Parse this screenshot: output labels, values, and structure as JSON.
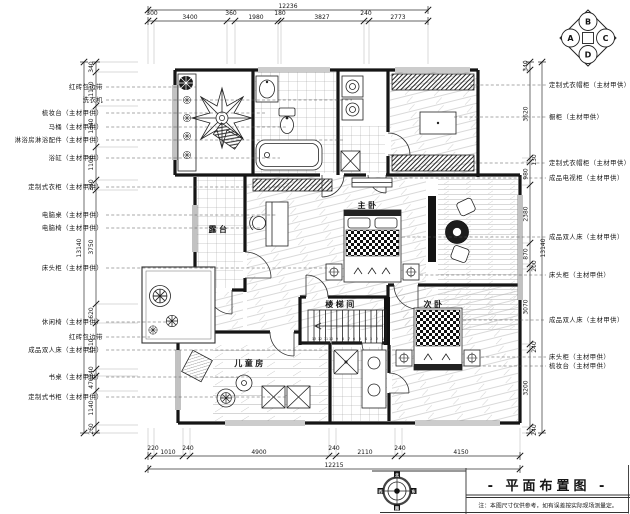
{
  "drawing": {
    "title": "- 平面布置图 -",
    "note": "注：本图尺寸仅供参考，如有误差按实际现场测量定。"
  },
  "elevation_symbol": {
    "top": "B",
    "left": "A",
    "right": "C",
    "bottom": "D"
  },
  "compass": {
    "n": "北",
    "e": "东",
    "s": "南",
    "w": "西"
  },
  "rooms": {
    "master_bedroom": "主卧",
    "second_bedroom": "次卧",
    "kids_room": "儿童房",
    "stair_hall": "楼梯间",
    "terrace": "露台"
  },
  "dims": {
    "top_total": "12236",
    "top_segments": [
      "300",
      "3400",
      "360",
      "1980",
      "180",
      "3827",
      "240",
      "2773"
    ],
    "bottom_total": "12215",
    "bottom_segments": [
      "220",
      "1010",
      "240",
      "4900",
      "240",
      "2110",
      "240",
      "4150"
    ],
    "left_total": "13140",
    "left_segments": [
      "340",
      "1110",
      "1340",
      "1100",
      "340",
      "3750",
      "620",
      "1510",
      "240",
      "470",
      "1140",
      "260"
    ],
    "right_total": "13140",
    "right_segments": [
      "340",
      "3620",
      "130",
      "980",
      "2380",
      "870",
      "200",
      "3070",
      "240",
      "3200",
      "240"
    ]
  },
  "annotations": {
    "left": [
      "红砖包边带",
      "洗衣机",
      "梳妆台（主材甲供）",
      "马桶（主材甲供）",
      "淋浴房淋浴配件（主材甲供）",
      "浴缸（主材甲供）",
      "定制式衣柜（主材甲供）",
      "电脑桌（主材甲供）",
      "电脑椅（主材甲供）",
      "床头柜（主材甲供）",
      "休闲椅（主材甲供）",
      "红砖包边带",
      "成品双人床（主材甲供）",
      "书桌（主材甲供）",
      "定制式书柜（主材甲供）"
    ],
    "right": [
      "定制式衣帽柜（主材甲供）",
      "橱柜（主材甲供）",
      "定制式衣帽柜（主材甲供）",
      "成品电视柜（主材甲供）",
      "成品双人床（主材甲供）",
      "床头柜（主材甲供）",
      "成品双人床（主材甲供）",
      "床头柜（主材甲供）",
      "梳妆台（主材甲供）"
    ]
  },
  "stairs": {
    "steps": [
      "13",
      "12",
      "11",
      "10",
      "9",
      "8",
      "7",
      "6",
      "5",
      "4",
      "3",
      "2",
      "1"
    ]
  }
}
